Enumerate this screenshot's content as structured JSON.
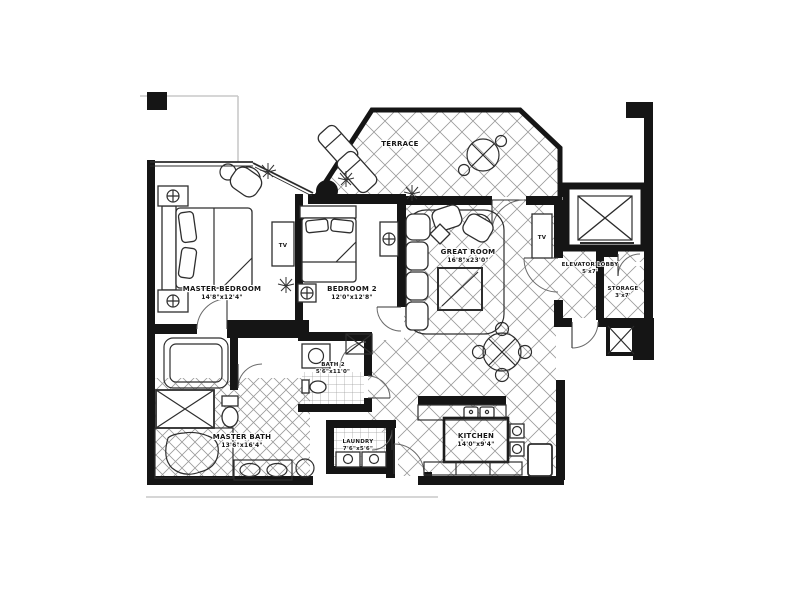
{
  "colors": {
    "ink": "#151515",
    "tile": "#9b9b9b",
    "faint": "#c9c9c9",
    "paper": "#ffffff"
  },
  "rooms": {
    "terrace": {
      "name": "TERRACE",
      "dims": ""
    },
    "master_bedroom": {
      "name": "MASTER BEDROOM",
      "dims": "14'8\"x12'4\""
    },
    "bedroom2": {
      "name": "BEDROOM 2",
      "dims": "12'0\"x12'8\""
    },
    "great_room": {
      "name": "GREAT ROOM",
      "dims": "16'8\"x23'0\""
    },
    "elevator_lobby": {
      "name": "ELEVATOR LOBBY",
      "dims": "5'x7'"
    },
    "storage": {
      "name": "STORAGE",
      "dims": "3'x7'"
    },
    "master_bath": {
      "name": "MASTER BATH",
      "dims": "13'6\"x16'4\""
    },
    "bath2": {
      "name": "BATH 2",
      "dims": "5'6\"x11'0\""
    },
    "laundry": {
      "name": "LAUNDRY",
      "dims": "7'6\"x5'6\""
    },
    "kitchen": {
      "name": "KITCHEN",
      "dims": "14'0\"x9'4\""
    }
  },
  "labels": {
    "tv_master": "TV",
    "tv_great": "TV"
  }
}
